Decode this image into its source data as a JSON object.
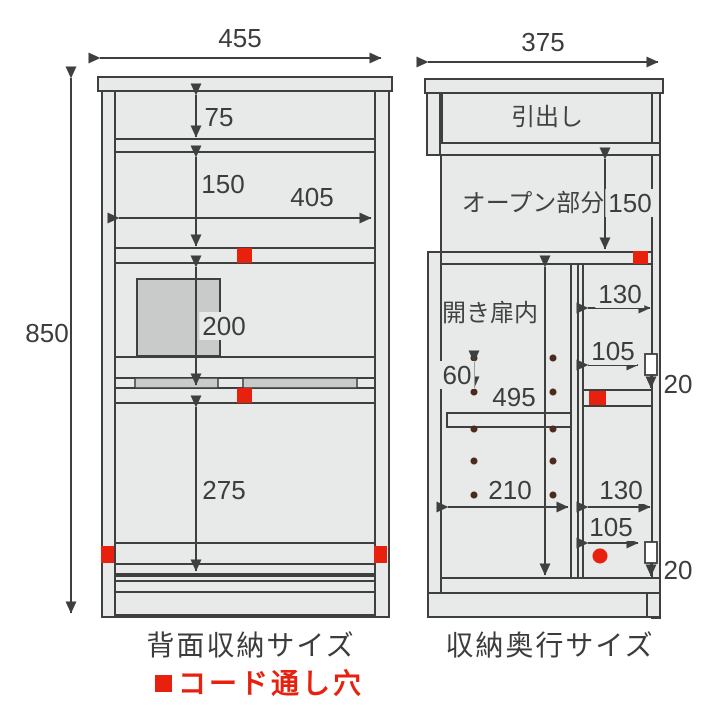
{
  "colors": {
    "accent_red": "#e8210f",
    "line": "#3f3f3f",
    "panel_fill": "#e8e9e9",
    "shade_fill": "#c9caca",
    "hole_dot": "#4a2b1c",
    "text": "#3d3d3d"
  },
  "left_view": {
    "caption": "背面収納サイズ",
    "dims": {
      "width": "455",
      "height": "850",
      "top_shelf": "75",
      "upper_open": "150",
      "inner_width": "405",
      "middle": "200",
      "lower": "275"
    }
  },
  "right_view": {
    "caption": "収納奥行サイズ",
    "labels": {
      "drawer": "引出し",
      "open_part": "オープン部分",
      "door_inside": "開き扉内"
    },
    "dims": {
      "width": "375",
      "open_height": "150",
      "upper_depth": "130",
      "upper_inner_depth": "105",
      "upper_gap": "20",
      "pin_pitch": "60",
      "door_height": "495",
      "door_depth": "210",
      "lower_depth": "130",
      "lower_inner_depth": "105",
      "lower_gap": "20"
    }
  },
  "legend": {
    "label": "コード通し穴"
  }
}
